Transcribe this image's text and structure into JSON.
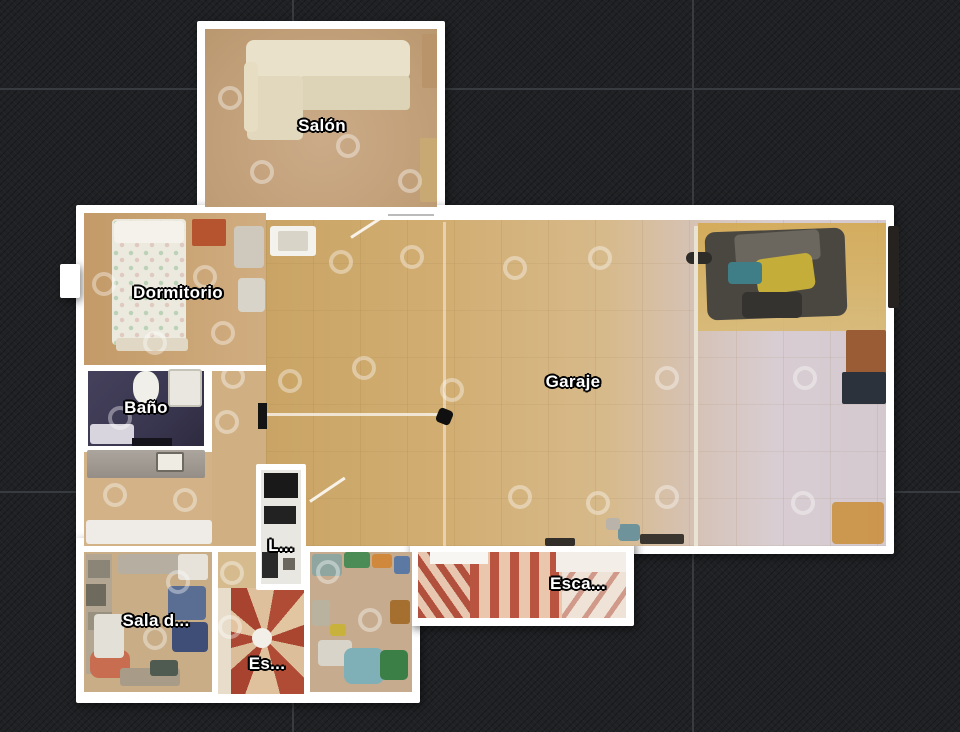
{
  "view": {
    "name": "floor-plan-view",
    "background_color": "#1f2124",
    "grid_color": "#383b3f",
    "wall_color": "#ffffff"
  },
  "floorplan": {
    "rooms": [
      {
        "id": "salon",
        "label": "Salón"
      },
      {
        "id": "dormitorio",
        "label": "Dormitorio"
      },
      {
        "id": "bano",
        "label": "Baño"
      },
      {
        "id": "garaje",
        "label": "Garaje"
      },
      {
        "id": "escalera",
        "label": "Esca..."
      },
      {
        "id": "lavadero",
        "label": "L..."
      },
      {
        "id": "escalera-caracol",
        "label": "Es..."
      },
      {
        "id": "sala-de-estar",
        "label": "Sala d..."
      }
    ],
    "floor_colors": {
      "wood_tan": "#cdaa72",
      "garage_light": "#d8cdd2",
      "bath_dark": "#413d56",
      "stair_red": "#b2503e"
    },
    "scan_points": [
      [
        230,
        98
      ],
      [
        262,
        172
      ],
      [
        348,
        146
      ],
      [
        410,
        181
      ],
      [
        104,
        284
      ],
      [
        205,
        277
      ],
      [
        223,
        333
      ],
      [
        155,
        343
      ],
      [
        120,
        418
      ],
      [
        233,
        377
      ],
      [
        227,
        422
      ],
      [
        115,
        495
      ],
      [
        185,
        500
      ],
      [
        341,
        262
      ],
      [
        412,
        257
      ],
      [
        515,
        268
      ],
      [
        600,
        258
      ],
      [
        290,
        381
      ],
      [
        364,
        368
      ],
      [
        452,
        390
      ],
      [
        520,
        497
      ],
      [
        598,
        503
      ],
      [
        667,
        378
      ],
      [
        667,
        497
      ],
      [
        805,
        378
      ],
      [
        803,
        503
      ],
      [
        328,
        572
      ],
      [
        370,
        620
      ],
      [
        178,
        582
      ],
      [
        232,
        573
      ],
      [
        230,
        627
      ],
      [
        155,
        638
      ]
    ]
  }
}
